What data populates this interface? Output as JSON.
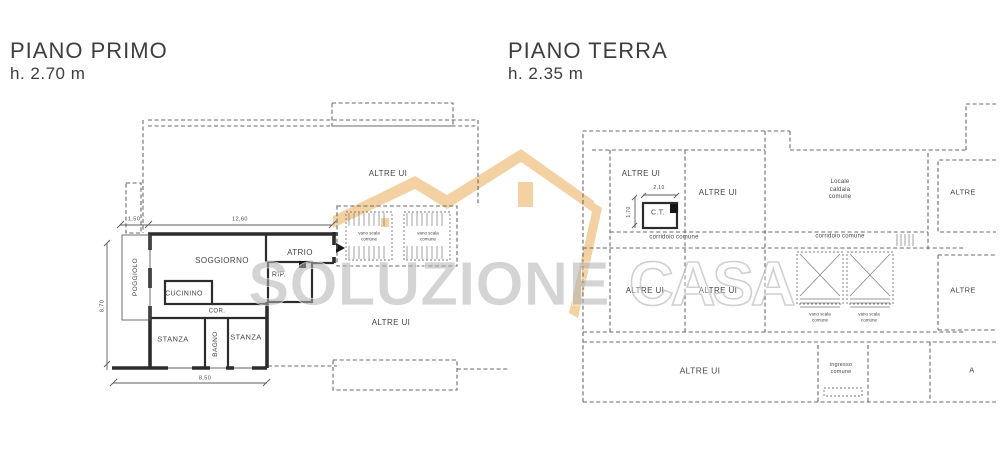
{
  "watermark": {
    "brand_left": "SOLUZIONE",
    "brand_right": "CASA",
    "house_color": "#f2ca92",
    "text_color": "#bdbdbd"
  },
  "plan_primo": {
    "title": "PIANO PRIMO",
    "height_label": "h. 2.70 m",
    "rooms": {
      "poggiolo": "POGGIOLO",
      "soggiorno": "SOGGIORNO",
      "atrio": "ATRIO",
      "rip": "RIP.",
      "cucinino": "CUCININO",
      "cor": "COR.",
      "stanza_left": "STANZA",
      "bagno": "BAGNO",
      "stanza_right": "STANZA",
      "altre_ui_top": "ALTRE UI",
      "altre_ui_bottom": "ALTRE UI",
      "vano_scala_1": "vano scala\ncomune",
      "vano_scala_2": "vano scala\ncomune"
    },
    "dimensions": {
      "balcony_width": "1,50",
      "facade_width": "12,60",
      "side_depth": "8,70",
      "bottom_width": "8,50"
    }
  },
  "plan_terra": {
    "title": "PIANO TERRA",
    "height_label": "h. 2.35 m",
    "rooms": {
      "altre_ui_1": "ALTRE UI",
      "altre_ui_2": "ALTRE UI",
      "ct": "C.T.",
      "corridoio_1": "corridoio comune",
      "locale_caldaia": "Locale\ncaldaia\ncomune",
      "corridoio_2": "corridoio comune",
      "altre_ui_3": "ALTRE UI",
      "altre_ui_4": "ALTRE UI",
      "vano_scala_1": "vano scala\ncomune",
      "vano_scala_2": "vano scala\ncomune",
      "altre_ui_big": "ALTRE UI",
      "ingresso": "ingresso\ncomune",
      "altre_right_1": "ALTRE",
      "altre_right_2": "ALTRE",
      "a_truncated": "A"
    },
    "dimensions": {
      "ct_width": "2,10",
      "ct_height": "1,70"
    }
  }
}
